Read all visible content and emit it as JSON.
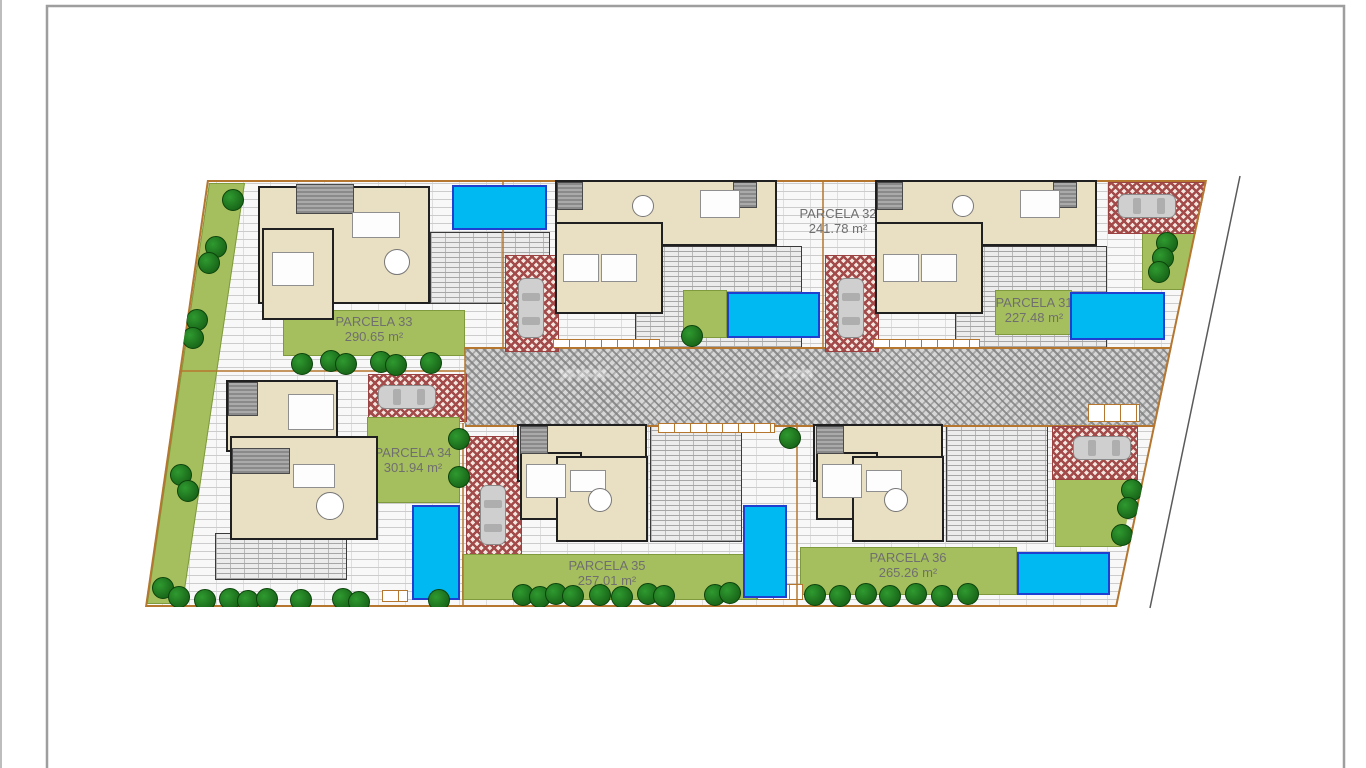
{
  "plan": {
    "watermark": "WWW.······················.COM",
    "palette": {
      "lawn": "#a6bf5e",
      "tree": "#1a6b1a",
      "pool": "#00b9f2",
      "pool_border": "#1e3fd0",
      "driveway": "#a34b4b",
      "boundary": "#b5762f",
      "house_fill": "#e9dfc2",
      "road": "#d6d6d6",
      "label_text": "#6f6f6f",
      "frame": "#9e9e9e"
    },
    "parcels": [
      {
        "name": "PARCELA 33",
        "area": "290.65 m²",
        "cx": 374,
        "cy": 314,
        "patch": [
          283,
          310,
          182,
          46
        ]
      },
      {
        "name": "PARCELA 32",
        "area": "241.78 m²",
        "cx": 838,
        "cy": 206
      },
      {
        "name": "PARCELA 31",
        "area": "227.48 m²",
        "cx": 1034,
        "cy": 295,
        "patch": [
          995,
          290,
          77,
          45
        ]
      },
      {
        "name": "PARCELA 34",
        "area": "301.94 m²",
        "cx": 413,
        "cy": 445,
        "patch": [
          367,
          417,
          93,
          86
        ]
      },
      {
        "name": "PARCELA 35",
        "area": "257.01 m²",
        "cx": 607,
        "cy": 558,
        "patch": [
          462,
          554,
          295,
          46
        ]
      },
      {
        "name": "PARCELA 36",
        "area": "265.26 m²",
        "cx": 908,
        "cy": 550,
        "patch": [
          800,
          547,
          217,
          48
        ]
      }
    ],
    "road": [
      465,
      347,
      710,
      76
    ],
    "decks": [
      [
        635,
        246,
        165,
        100
      ],
      [
        955,
        246,
        150,
        100
      ],
      [
        430,
        232,
        118,
        70
      ],
      [
        215,
        533,
        130,
        45
      ],
      [
        650,
        425,
        90,
        115
      ],
      [
        946,
        425,
        100,
        115
      ]
    ],
    "lawns": [
      {
        "r": [
          209,
          183,
          36,
          421
        ],
        "skew": -8.4
      },
      {
        "r": [
          683,
          290,
          44,
          48
        ]
      },
      {
        "r": [
          1142,
          232,
          53,
          58
        ],
        "clip": "polygon(0 0,100% 0,78% 100%,0 100%)"
      },
      {
        "r": [
          1055,
          473,
          82,
          74
        ],
        "clip": "polygon(0 0,100% 0,81% 100%,0 100%)"
      }
    ],
    "drives": [
      [
        505,
        255,
        52,
        95
      ],
      [
        825,
        255,
        52,
        95
      ],
      [
        1108,
        182,
        98,
        50
      ],
      [
        368,
        374,
        97,
        46
      ],
      [
        466,
        436,
        54,
        128
      ],
      [
        1052,
        426,
        84,
        52
      ]
    ],
    "tiles": [
      [
        553,
        339,
        107,
        9
      ],
      [
        873,
        339,
        107,
        9
      ],
      [
        658,
        423,
        117,
        10
      ],
      [
        1088,
        404,
        52,
        18
      ],
      [
        757,
        584,
        46,
        16
      ],
      [
        382,
        590,
        26,
        12
      ]
    ],
    "pools": [
      [
        452,
        185,
        95,
        45
      ],
      [
        727,
        292,
        93,
        46
      ],
      [
        1070,
        292,
        95,
        48
      ],
      [
        412,
        505,
        48,
        95
      ],
      [
        743,
        505,
        44,
        93
      ],
      [
        1017,
        552,
        93,
        43
      ]
    ],
    "cars": [
      {
        "x": 518,
        "y": 278,
        "w": 26,
        "h": 60,
        "o": "v"
      },
      {
        "x": 838,
        "y": 278,
        "w": 26,
        "h": 60,
        "o": "v"
      },
      {
        "x": 1118,
        "y": 194,
        "w": 58,
        "h": 24,
        "o": "h"
      },
      {
        "x": 378,
        "y": 385,
        "w": 58,
        "h": 24,
        "o": "h"
      },
      {
        "x": 480,
        "y": 485,
        "w": 26,
        "h": 60,
        "o": "v"
      },
      {
        "x": 1073,
        "y": 436,
        "w": 58,
        "h": 24,
        "o": "h"
      }
    ],
    "houses": [
      {
        "walls": [
          [
            258,
            186,
            172,
            118
          ],
          [
            262,
            228,
            72,
            92
          ]
        ],
        "grey": [
          [
            296,
            184,
            58,
            30
          ]
        ],
        "furn": [
          [
            352,
            212,
            48,
            26
          ],
          [
            272,
            252,
            42,
            34
          ]
        ],
        "round": [
          [
            397,
            262,
            13
          ]
        ]
      },
      {
        "walls": [
          [
            555,
            180,
            222,
            66
          ],
          [
            555,
            222,
            108,
            92
          ]
        ],
        "grey": [
          [
            557,
            182,
            26,
            28
          ],
          [
            733,
            182,
            24,
            26
          ]
        ],
        "furn": [
          [
            700,
            190,
            40,
            28
          ],
          [
            563,
            254,
            36,
            28
          ],
          [
            601,
            254,
            36,
            28
          ]
        ],
        "round": [
          [
            643,
            206,
            11
          ]
        ]
      },
      {
        "walls": [
          [
            875,
            180,
            222,
            66
          ],
          [
            875,
            222,
            108,
            92
          ]
        ],
        "grey": [
          [
            877,
            182,
            26,
            28
          ],
          [
            1053,
            182,
            24,
            26
          ]
        ],
        "furn": [
          [
            1020,
            190,
            40,
            28
          ],
          [
            883,
            254,
            36,
            28
          ],
          [
            921,
            254,
            36,
            28
          ]
        ],
        "round": [
          [
            963,
            206,
            11
          ]
        ]
      },
      {
        "walls": [
          [
            226,
            380,
            112,
            72
          ],
          [
            230,
            436,
            148,
            104
          ]
        ],
        "grey": [
          [
            228,
            382,
            30,
            34
          ],
          [
            232,
            448,
            58,
            26
          ]
        ],
        "furn": [
          [
            288,
            394,
            46,
            36
          ],
          [
            293,
            464,
            42,
            24
          ]
        ],
        "round": [
          [
            330,
            506,
            14
          ]
        ]
      },
      {
        "walls": [
          [
            517,
            424,
            130,
            58
          ],
          [
            520,
            452,
            62,
            68
          ],
          [
            556,
            456,
            92,
            86
          ]
        ],
        "grey": [
          [
            520,
            426,
            28,
            28
          ]
        ],
        "furn": [
          [
            526,
            464,
            40,
            34
          ],
          [
            570,
            470,
            36,
            22
          ]
        ],
        "round": [
          [
            600,
            500,
            12
          ]
        ]
      },
      {
        "walls": [
          [
            813,
            424,
            130,
            58
          ],
          [
            816,
            452,
            62,
            68
          ],
          [
            852,
            456,
            92,
            86
          ]
        ],
        "grey": [
          [
            816,
            426,
            28,
            28
          ]
        ],
        "furn": [
          [
            822,
            464,
            40,
            34
          ],
          [
            866,
            470,
            36,
            22
          ]
        ],
        "round": [
          [
            896,
            500,
            12
          ]
        ]
      }
    ],
    "trees": [
      [
        233,
        200
      ],
      [
        216,
        247
      ],
      [
        209,
        263
      ],
      [
        197,
        320
      ],
      [
        193,
        338
      ],
      [
        181,
        475
      ],
      [
        188,
        491
      ],
      [
        163,
        588
      ],
      [
        179,
        597
      ],
      [
        205,
        600
      ],
      [
        230,
        599
      ],
      [
        248,
        601
      ],
      [
        267,
        599
      ],
      [
        301,
        600
      ],
      [
        343,
        599
      ],
      [
        359,
        602
      ],
      [
        439,
        600
      ],
      [
        302,
        364
      ],
      [
        331,
        361
      ],
      [
        346,
        364
      ],
      [
        381,
        362
      ],
      [
        396,
        365
      ],
      [
        431,
        363
      ],
      [
        459,
        439
      ],
      [
        459,
        477
      ],
      [
        692,
        336
      ],
      [
        790,
        438
      ],
      [
        523,
        595
      ],
      [
        540,
        597
      ],
      [
        556,
        594
      ],
      [
        573,
        596
      ],
      [
        600,
        595
      ],
      [
        622,
        597
      ],
      [
        648,
        594
      ],
      [
        664,
        596
      ],
      [
        715,
        595
      ],
      [
        730,
        593
      ],
      [
        815,
        595
      ],
      [
        840,
        596
      ],
      [
        866,
        594
      ],
      [
        890,
        596
      ],
      [
        916,
        594
      ],
      [
        942,
        596
      ],
      [
        968,
        594
      ],
      [
        1167,
        243
      ],
      [
        1163,
        258
      ],
      [
        1159,
        272
      ],
      [
        1132,
        490
      ],
      [
        1128,
        508
      ],
      [
        1122,
        535
      ]
    ]
  }
}
